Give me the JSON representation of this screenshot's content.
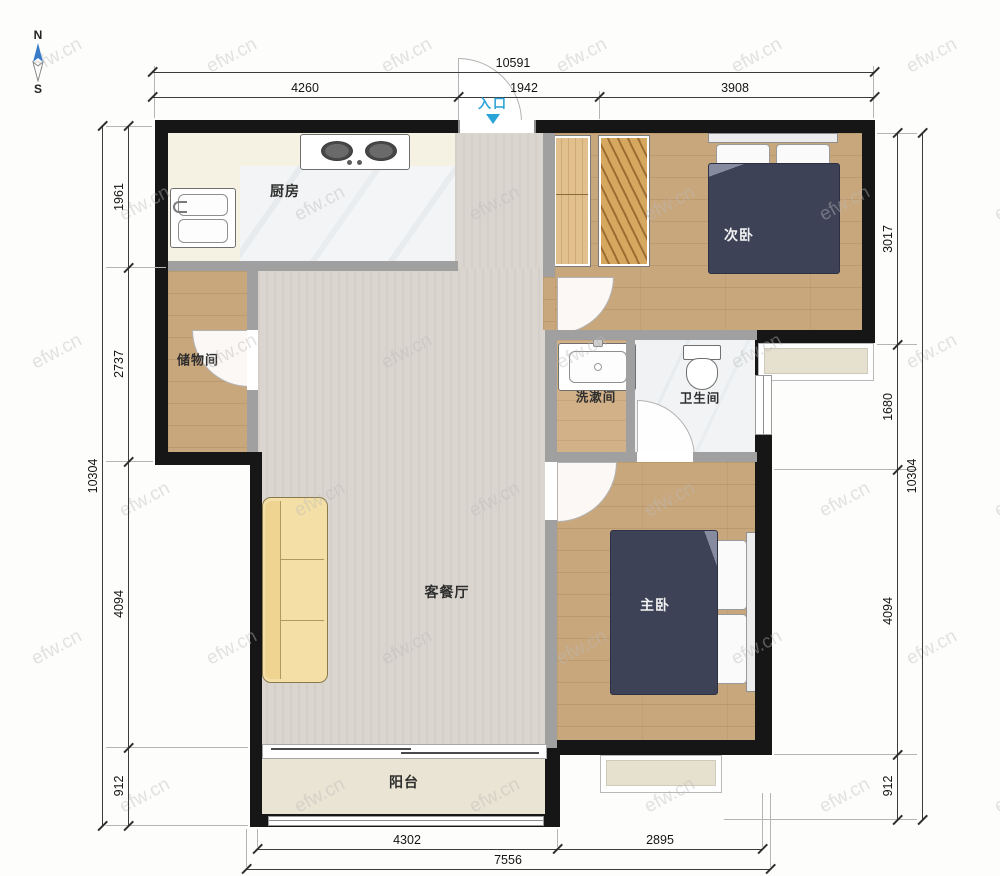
{
  "compass": {
    "north": "N",
    "south": "S"
  },
  "entrance": {
    "label": "入口"
  },
  "watermark": {
    "text": "efw.cn"
  },
  "rooms": {
    "kitchen": "厨房",
    "storage": "储物间",
    "living": "客餐厅",
    "balcony": "阳台",
    "bedroom2": "次卧",
    "bedroom1": "主卧",
    "washroom": "洗漱间",
    "bathroom": "卫生间"
  },
  "dims": {
    "top": {
      "total": "10591",
      "segments": [
        "4260",
        "1942",
        "3908"
      ]
    },
    "bottom": {
      "total": "7556",
      "segments": [
        "4302",
        "2895"
      ]
    },
    "left": {
      "total": "10304",
      "segments": [
        "1961",
        "2737",
        "4094",
        "912"
      ]
    },
    "right": {
      "total": "10304",
      "segments": [
        "3017",
        "1680",
        "4094",
        "912"
      ]
    }
  },
  "colors": {
    "entrance_blue": "#2aa3d8",
    "bed_navy": "#3e4257",
    "sofa_cream": "#f4e0a6",
    "wood_floor": "#c9a77d",
    "exterior_wall": "#161616",
    "interior_wall": "#a0a0a0"
  }
}
